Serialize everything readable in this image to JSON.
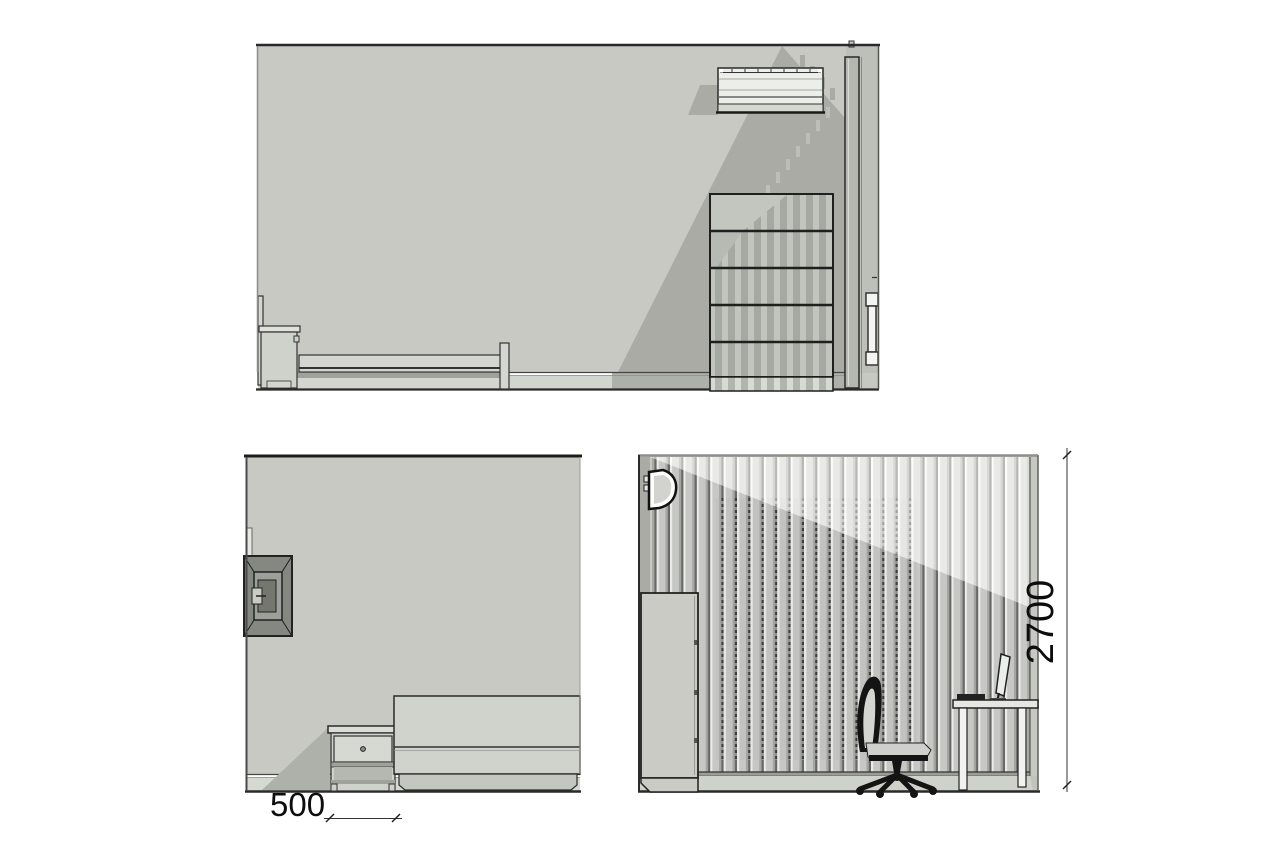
{
  "sheet": {
    "type": "interior-elevation-drawing",
    "background": "#ffffff"
  },
  "dimensions": {
    "nightstand_width": "500",
    "wall_height": "2700"
  },
  "palette": {
    "wall": "#c7c9c2",
    "shadow": "#a9aba4",
    "floor": "#d3d5cf",
    "furniture_light": "#d4d6d0",
    "outline": "#2a2a2a",
    "slat_dark_gap": "#6e6f6b",
    "chair_black": "#141414"
  },
  "views": {
    "top": "long-wall-elevation-with-bed-shelving-and-ac",
    "bottom_left": "head-wall-elevation-with-tv-nightstand-and-headboard",
    "bottom_right": "slat-wall-elevation-with-wardrobe-desk-and-chair"
  }
}
